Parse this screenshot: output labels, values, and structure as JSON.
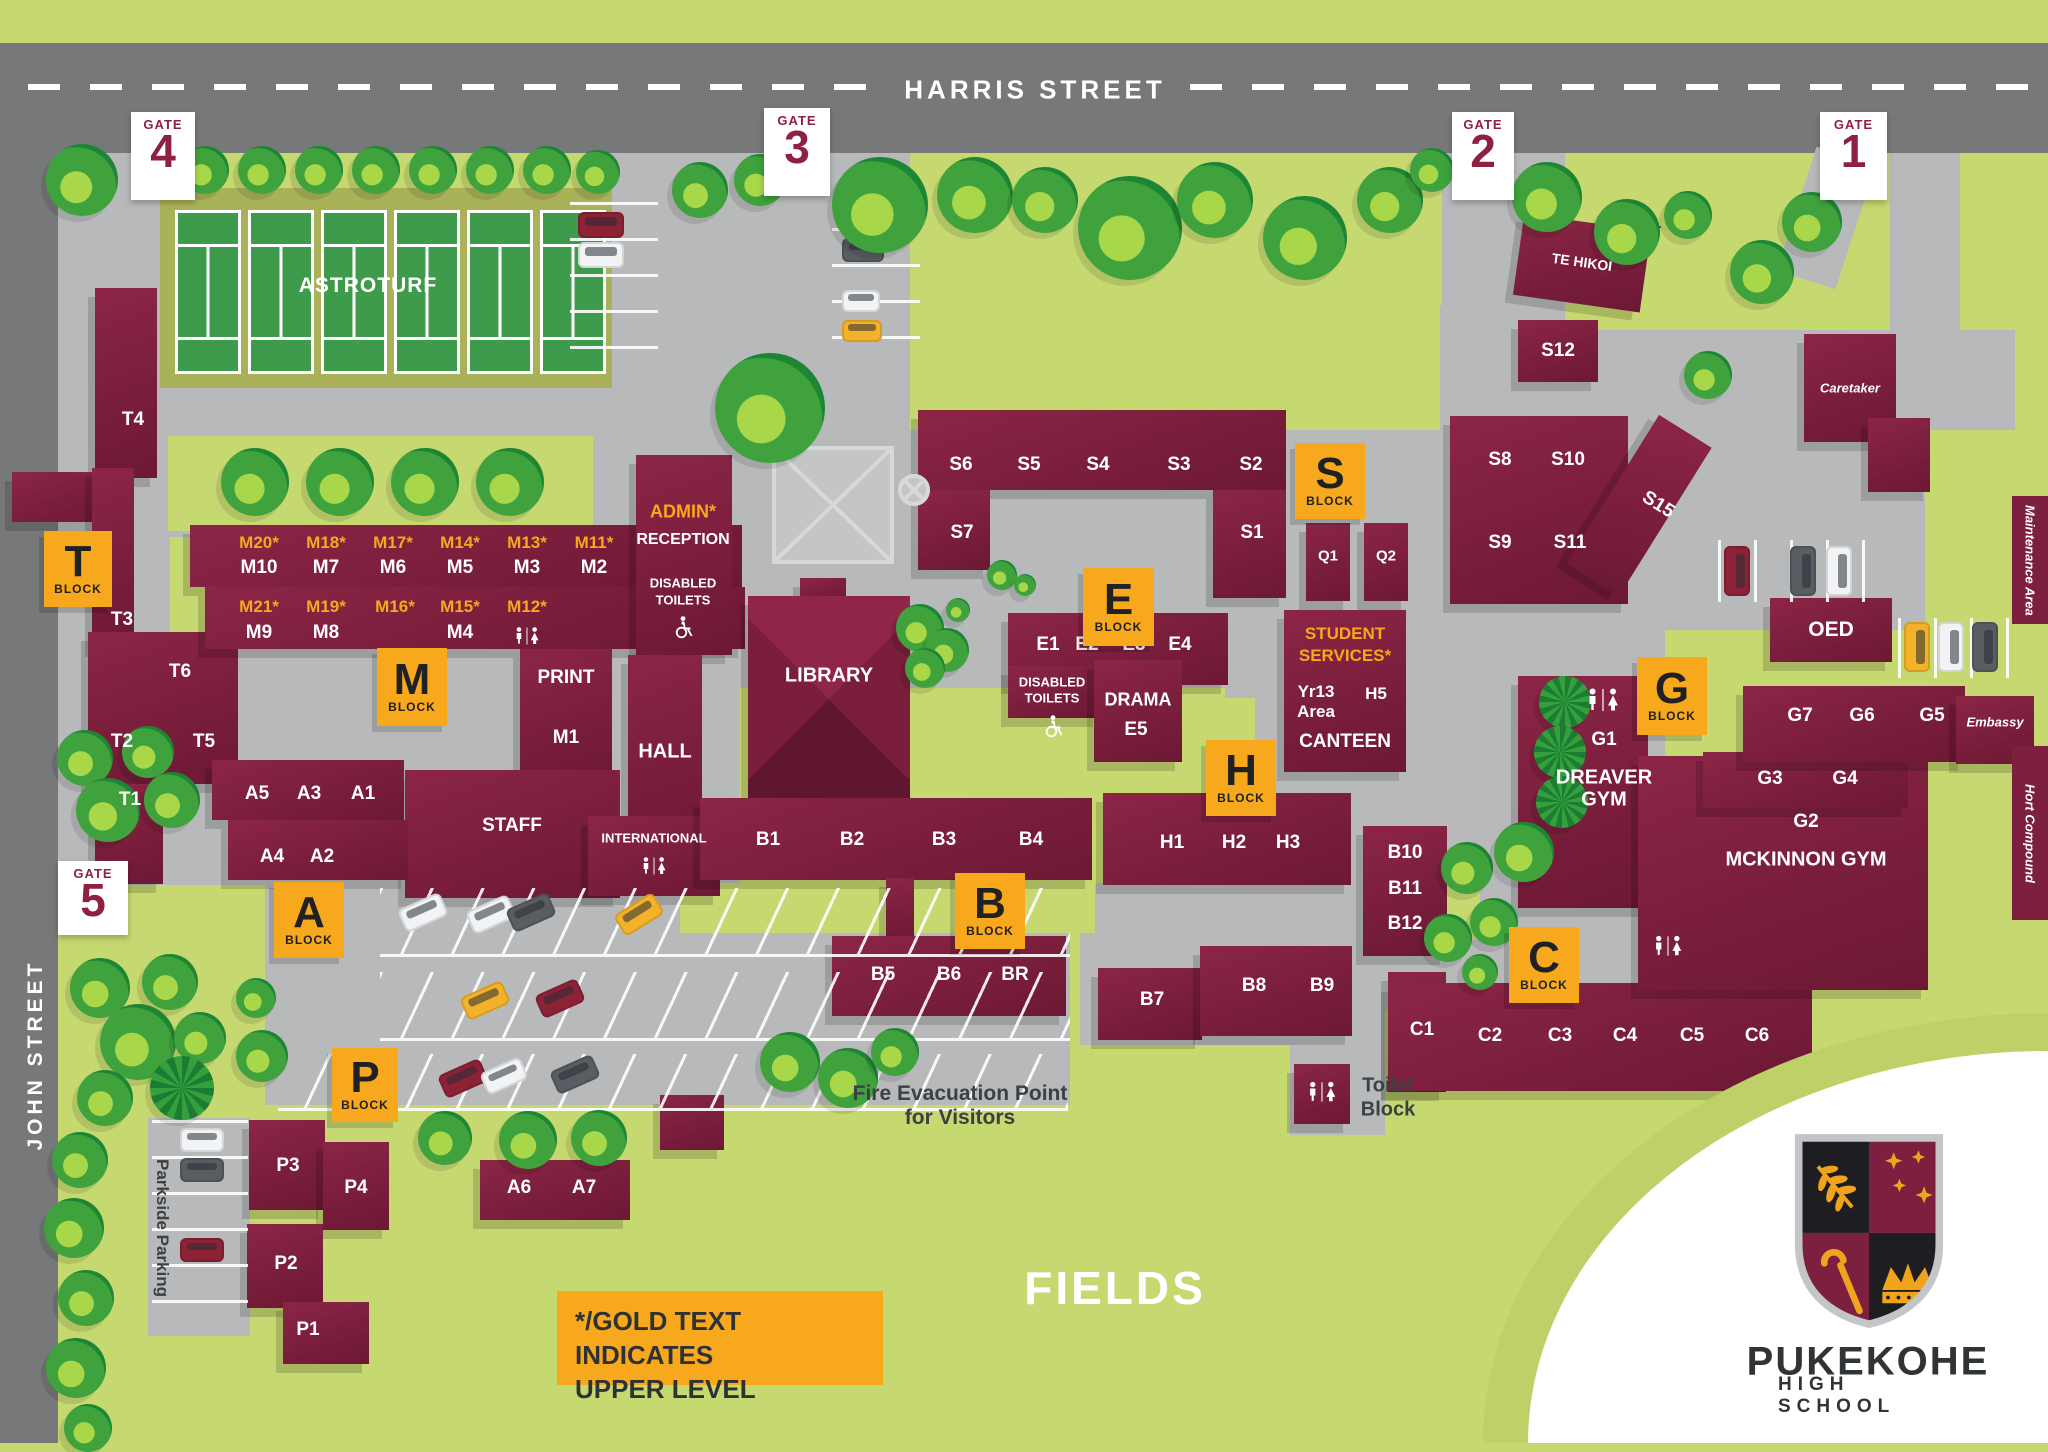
{
  "title": "Pukekohe High School campus map",
  "streets": {
    "harris": "HARRIS STREET",
    "john": "JOHN STREET"
  },
  "gates": {
    "word": "GATE",
    "n1": "1",
    "n2": "2",
    "n3": "3",
    "n4": "4",
    "n5": "5"
  },
  "badges": {
    "word": "BLOCK",
    "t": "T",
    "m": "M",
    "a": "A",
    "p": "P",
    "b": "B",
    "e": "E",
    "h": "H",
    "s": "S",
    "c": "C",
    "g": "G"
  },
  "labels": {
    "astroturf": "ASTROTURF",
    "fields": "FIELDS",
    "library": "LIBRARY",
    "hall": "HALL",
    "staff": "STAFF",
    "international": "INTERNATIONAL",
    "print": "PRINT",
    "admin": "ADMIN*",
    "reception": "RECEPTION",
    "disabled": "DISABLED",
    "toilets": "TOILETS",
    "drama": "DRAMA",
    "canteen": "CANTEEN",
    "student": "STUDENT",
    "services": "SERVICES*",
    "yr13": "Yr13",
    "area": "Area",
    "dreaver": "DREAVER",
    "gym": "GYM",
    "mckinnon": "MCKINNON GYM",
    "oed": "OED",
    "embassy": "Embassy",
    "caretaker": "Caretaker",
    "te_hikoi": "TE HIKOI",
    "maintenance": "Maintenance Area",
    "hort": "Hort Compound",
    "toilet": "Toilet",
    "block": "Block",
    "fire1": "Fire Evacuation Point",
    "fire2": "for Visitors",
    "parkside": "Parkside Parking"
  },
  "rooms": {
    "t1": "T1",
    "t2": "T2",
    "t3": "T3",
    "t4": "T4",
    "t5": "T5",
    "t6": "T6",
    "u11": "M11*",
    "u12": "M12*",
    "u13": "M13*",
    "u14": "M14*",
    "u15": "M15*",
    "u16": "M16*",
    "u17": "M17*",
    "u18": "M18*",
    "u19": "M19*",
    "u20": "M20*",
    "u21": "M21*",
    "m1": "M1",
    "m2": "M2",
    "m3": "M3",
    "m4": "M4",
    "m5": "M5",
    "m6": "M6",
    "m7": "M7",
    "m8": "M8",
    "m9": "M9",
    "m10": "M10",
    "a1": "A1",
    "a2": "A2",
    "a3": "A3",
    "a4": "A4",
    "a5": "A5",
    "a6": "A6",
    "a7": "A7",
    "p1": "P1",
    "p2": "P2",
    "p3": "P3",
    "p4": "P4",
    "s1": "S1",
    "s2": "S2",
    "s3": "S3",
    "s4": "S4",
    "s5": "S5",
    "s6": "S6",
    "s7": "S7",
    "s8": "S8",
    "s9": "S9",
    "s10": "S10",
    "s11": "S11",
    "s12": "S12",
    "s15": "S15",
    "q1": "Q1",
    "q2": "Q2",
    "e1": "E1",
    "e2": "E2",
    "e3": "E3",
    "e4": "E4",
    "e5": "E5",
    "h1": "H1",
    "h2": "H2",
    "h3": "H3",
    "h5": "H5",
    "b1": "B1",
    "b2": "B2",
    "b3": "B3",
    "b4": "B4",
    "b5": "B5",
    "b6": "B6",
    "br": "BR",
    "b7": "B7",
    "b8": "B8",
    "b9": "B9",
    "b10": "B10",
    "b11": "B11",
    "b12": "B12",
    "c1": "C1",
    "c2": "C2",
    "c3": "C3",
    "c4": "C4",
    "c5": "C5",
    "c6": "C6",
    "g1": "G1",
    "g2": "G2",
    "g3": "G3",
    "g4": "G4",
    "g5": "G5",
    "g6": "G6",
    "g7": "G7"
  },
  "legend": {
    "line1": "*/GOLD TEXT INDICATES",
    "line2": "UPPER LEVEL"
  },
  "logo": {
    "name": "PUKEKOHE",
    "sub": "HIGH SCHOOL"
  },
  "colors": {
    "grass": "#c6d870",
    "road": "#77787a",
    "concrete": "#b7b9bb",
    "building": "#7d2040",
    "gold": "#f7a81c",
    "court_green": "#3f9b4c",
    "maroon_text": "#8e2040",
    "white": "#ffffff"
  }
}
